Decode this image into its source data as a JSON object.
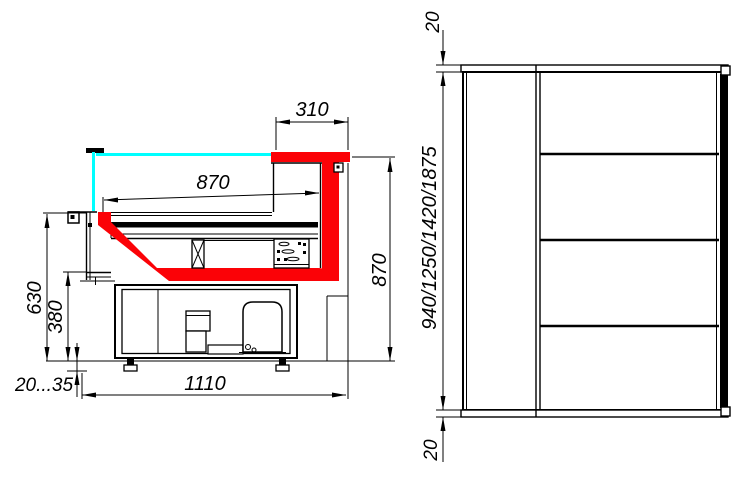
{
  "colors": {
    "red": "#fb0207",
    "cyan": "#00ffff",
    "line": "#000000",
    "background": "#ffffff"
  },
  "section_view": {
    "dims": {
      "canopy_depth": "310",
      "display_depth": "870",
      "front_height": "630",
      "base_height": "380",
      "feet_range": "20...35",
      "total_depth": "1110",
      "back_height": "870"
    }
  },
  "front_view": {
    "dims": {
      "top_cap": "20",
      "case_heights": "940/1250/1420/1875",
      "bottom_cap": "20"
    }
  }
}
